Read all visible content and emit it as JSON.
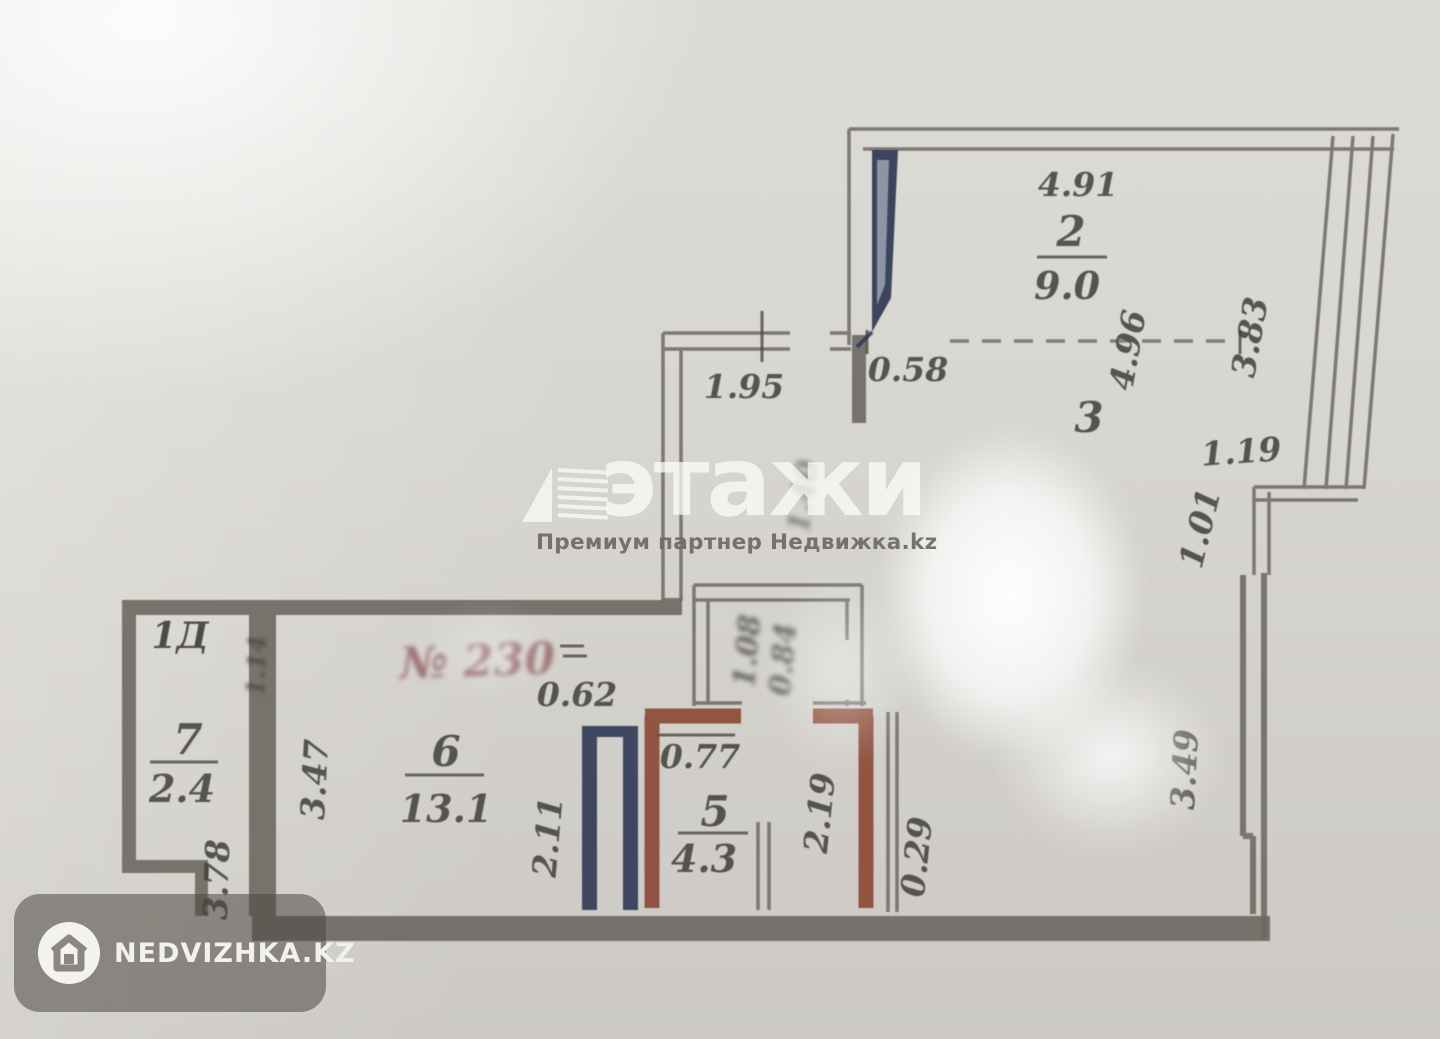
{
  "watermark": {
    "brand": "этажи",
    "partner_line": "Премиум партнер Недвижка.kz"
  },
  "corner_badge": {
    "label": "NEDVIZHKA.KZ"
  },
  "rooms": {
    "r2": {
      "number": "2",
      "area": "9.0"
    },
    "r3": {
      "number": "3"
    },
    "r5": {
      "number": "5",
      "area": "4.3"
    },
    "r6": {
      "number": "6",
      "area": "13.1"
    },
    "r7": {
      "number": "7",
      "area": "2.4"
    }
  },
  "dimensions": {
    "d491": "4.91",
    "d058": "0.58",
    "d195": "1.95",
    "d496": "4.96",
    "d383": "3.83",
    "d119": "1.19",
    "d101": "1.01",
    "d349": "3.49",
    "d029": "0.29",
    "d219": "2.19",
    "d077": "0.77",
    "d062": "0.62",
    "d211": "2.11",
    "d347": "3.47",
    "d378": "3.78"
  },
  "annotations": {
    "unit_label": "1Д",
    "red_note": "№ 230",
    "illegible_shaft_1": "1.08",
    "illegible_shaft_2": "0.84",
    "illegible_wall_note": "1.14",
    "illegible_corridor_note": "1.40"
  },
  "colors": {
    "wall": "#6b6861",
    "accent_blue": "#2e3954",
    "accent_brown": "#8c4a36",
    "ink": "#44423c",
    "red_ink": "#7a3640"
  }
}
